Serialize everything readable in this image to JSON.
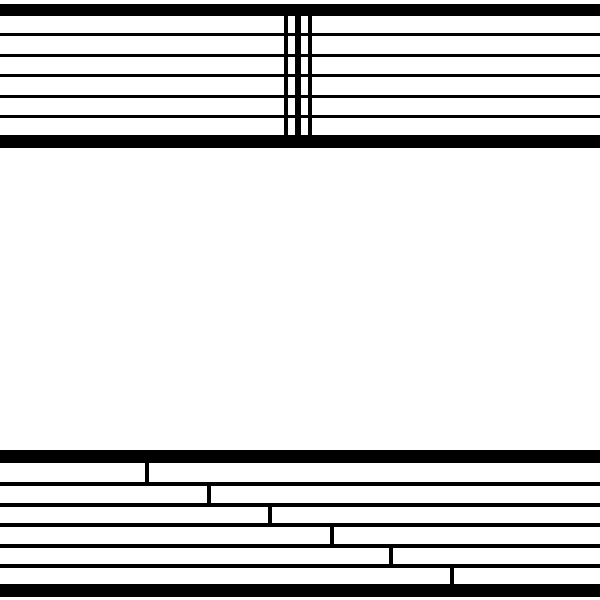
{
  "canvas": {
    "width": 600,
    "height": 600,
    "background_color": "#ffffff",
    "ink_color": "#000000"
  },
  "top_system": {
    "x": 0,
    "width": 600,
    "thick_bars": [
      {
        "y": 4,
        "h": 12
      },
      {
        "y": 135,
        "h": 13
      }
    ],
    "thin_lines": [
      {
        "y": 33,
        "h": 3
      },
      {
        "y": 54,
        "h": 3
      },
      {
        "y": 74,
        "h": 3
      },
      {
        "y": 95,
        "h": 3
      },
      {
        "y": 115,
        "h": 3
      }
    ],
    "barlines": [
      {
        "x": 284,
        "w": 4,
        "y1": 8,
        "y2": 146
      },
      {
        "x": 295,
        "w": 6,
        "y1": 8,
        "y2": 146
      },
      {
        "x": 308,
        "w": 4,
        "y1": 8,
        "y2": 146
      }
    ]
  },
  "bottom_system": {
    "x": 0,
    "width": 600,
    "thick_bars": [
      {
        "y": 450,
        "h": 13
      },
      {
        "y": 584,
        "h": 13
      }
    ],
    "thin_lines": [
      {
        "y": 482,
        "h": 3.5
      },
      {
        "y": 503,
        "h": 3.5
      },
      {
        "y": 523,
        "h": 3.5
      },
      {
        "y": 544,
        "h": 3.5
      },
      {
        "y": 564,
        "h": 3.5
      }
    ],
    "step_ticks": [
      {
        "x": 145,
        "w": 4,
        "y1": 455,
        "y2": 485
      },
      {
        "x": 207,
        "w": 4,
        "y1": 483,
        "y2": 506
      },
      {
        "x": 268,
        "w": 4,
        "y1": 504,
        "y2": 527
      },
      {
        "x": 330,
        "w": 4,
        "y1": 524,
        "y2": 547
      },
      {
        "x": 389,
        "w": 4,
        "y1": 545,
        "y2": 567
      },
      {
        "x": 450,
        "w": 4,
        "y1": 565,
        "y2": 592
      }
    ]
  }
}
